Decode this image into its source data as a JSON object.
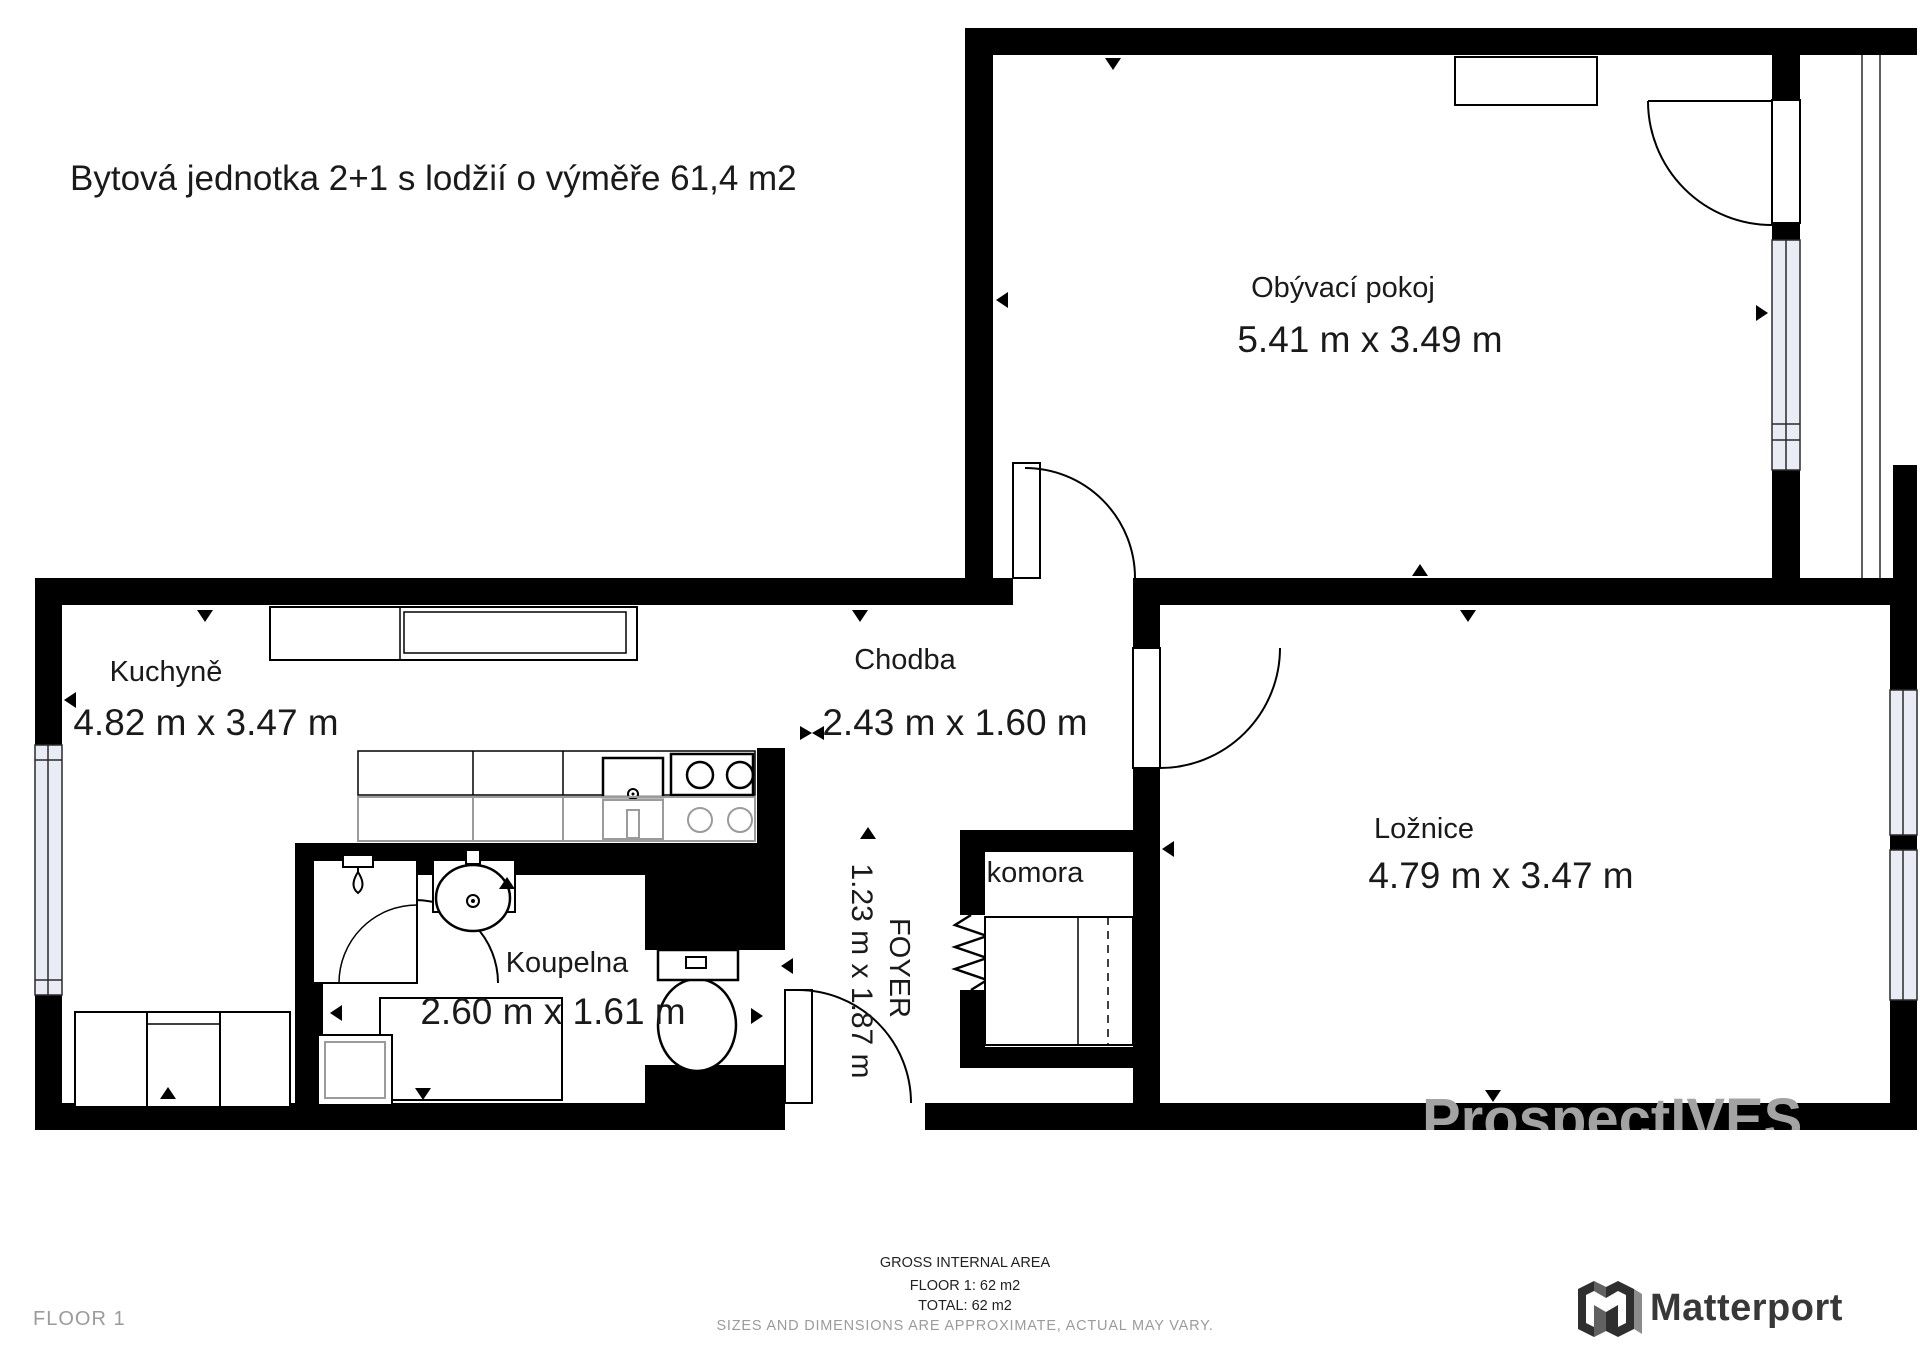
{
  "title": "Bytová jednotka 2+1 s lodžií o výměře 61,4 m2",
  "rooms": [
    {
      "id": "living",
      "name": "Obývací pokoj",
      "dims": "5.41 m x 3.49 m"
    },
    {
      "id": "kitchen",
      "name": "Kuchyně",
      "dims": "4.82 m x 3.47 m"
    },
    {
      "id": "hall",
      "name": "Chodba",
      "dims": "2.43 m x 1.60 m"
    },
    {
      "id": "bedroom",
      "name": "Ložnice",
      "dims": "4.79 m x 3.47 m"
    },
    {
      "id": "bathroom",
      "name": "Koupelna",
      "dims": "2.60 m x 1.61 m"
    },
    {
      "id": "storage",
      "name": "komora",
      "dims": ""
    },
    {
      "id": "foyer",
      "name": "FOYER",
      "dims": "1.23 m x 1.87 m"
    }
  ],
  "footer": {
    "area_heading": "GROSS INTERNAL AREA",
    "area_floor": "FLOOR 1: 62 m2",
    "area_total": "TOTAL: 62 m2",
    "disclaimer": "SIZES AND DIMENSIONS ARE APPROXIMATE, ACTUAL MAY VARY.",
    "floor_label": "FLOOR 1"
  },
  "watermark": "ProspectIVES",
  "brand": {
    "name": "Matterport"
  },
  "colors": {
    "wall": "#000000",
    "window_fill": "#e9ebf5",
    "fixture_gray": "#9b9b9b",
    "text": "#1a1a1a",
    "muted_gray": "#9b9b9b",
    "brand_dark": "#383838",
    "watermark_gray": "#a3a3a3"
  }
}
